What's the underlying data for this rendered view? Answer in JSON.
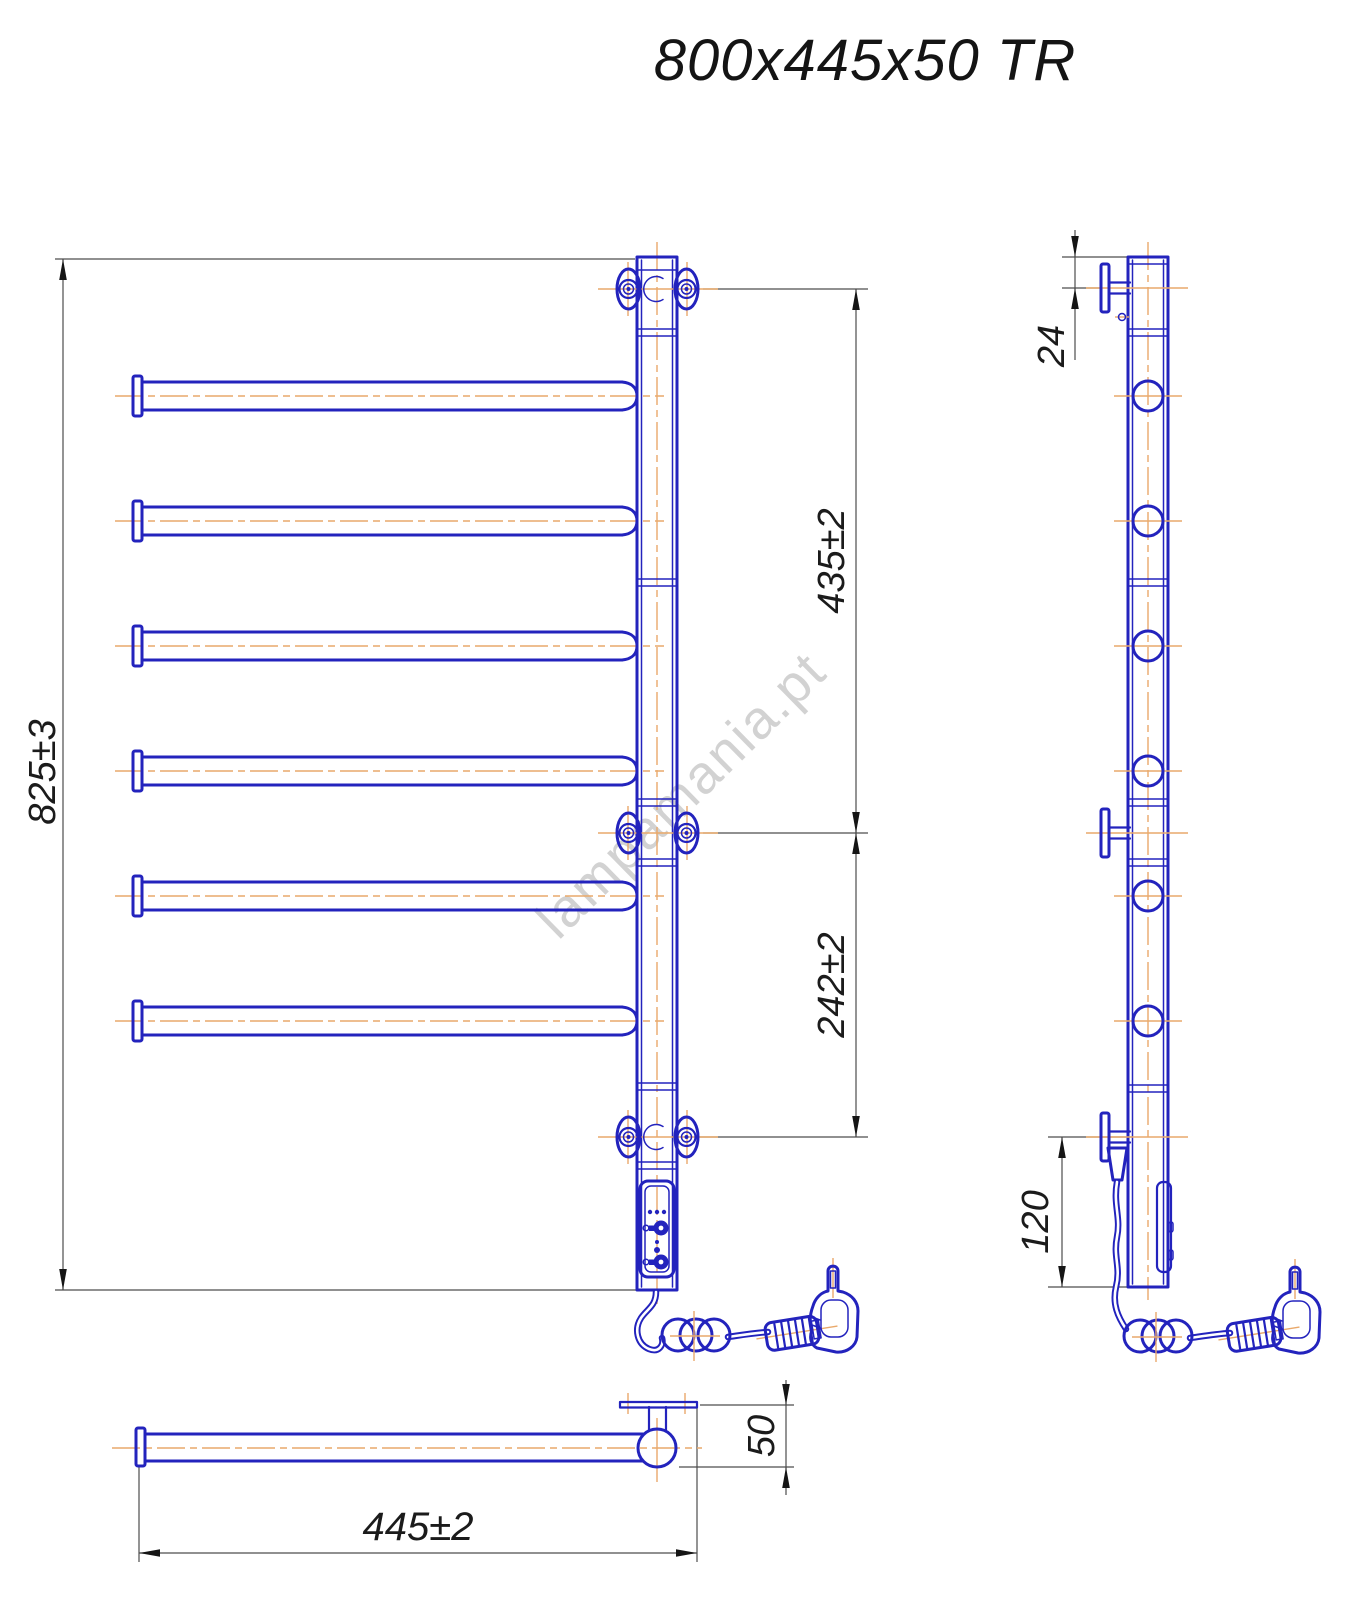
{
  "title": "800x445x50 TR",
  "watermark": "lampamania.pt",
  "dims": {
    "overall_height": "825±3",
    "upper_span": "435±2",
    "lower_span": "242±2",
    "top_offset": "24",
    "bottom_offset": "120",
    "width": "445±2",
    "depth": "50"
  },
  "drawing": {
    "views": [
      "front",
      "side",
      "bottom"
    ],
    "bars_count": 6,
    "colors": {
      "line": "#2323bd",
      "centerline": "#e9a96b",
      "dimension_line": "#4d4d4d",
      "text": "#1b1b1b",
      "watermark": "#b7b7b7"
    }
  }
}
